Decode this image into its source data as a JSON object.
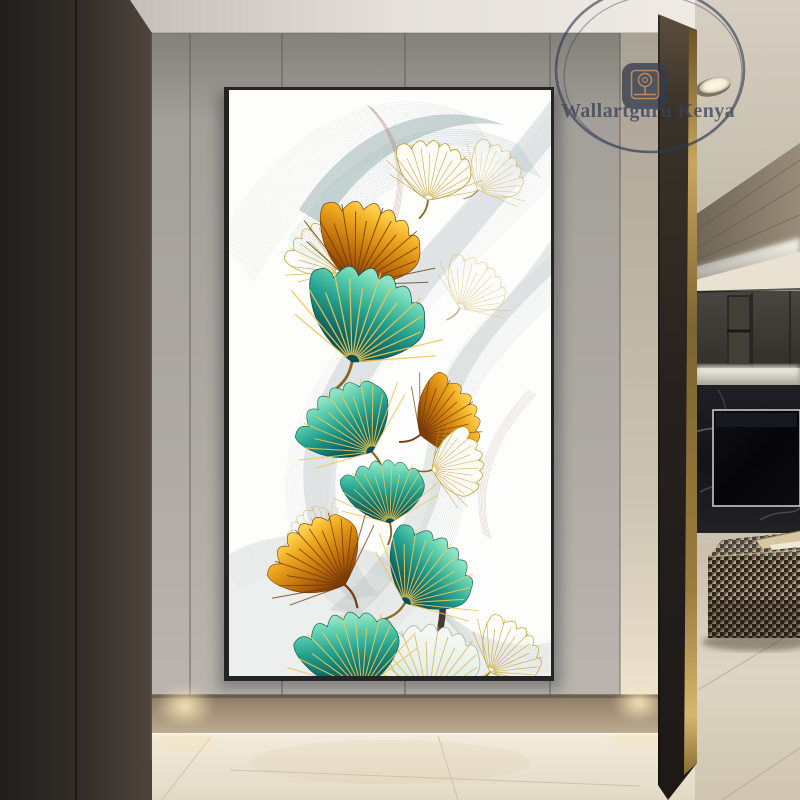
{
  "watermark": {
    "brand": "Wallartguru Kenya",
    "ring_color": "#2c3850",
    "text_color": "#39415a",
    "icon_bg": "#343b4f",
    "icon_stroke": "#c08552"
  },
  "scene": {
    "palette": {
      "left_wall_dark": "#211e1c",
      "left_wall_light": "#4d453d",
      "back_panels_top": "#a09c96",
      "back_panels_bottom": "#b9b4ad",
      "ceiling": "#eeeae4",
      "baseboard_tan": "#a3906f",
      "hall_floor": "#f0e9da",
      "pillar_dark": "#26211d",
      "brass_trim": "#c9a55f",
      "cabinet": "#3e3a36",
      "tv_marble": "#17171a",
      "living_floor": "#d8cfbe",
      "ottoman_dark": "#2b251c",
      "ottoman_light": "#b7a37d",
      "downlight_glow": "#ffe9bd"
    }
  },
  "artwork": {
    "canvas_px": {
      "x": 224,
      "y": 87,
      "w": 330,
      "h": 594
    },
    "face": {
      "x": 229,
      "y": 90,
      "w": 322,
      "h": 586
    },
    "background": "#fdfdfc",
    "palette": {
      "teal_dark": "#063e44",
      "teal_mid": "#23a18e",
      "teal_light": "#8fe3c4",
      "orange_dark": "#5e2a04",
      "orange_mid": "#d2820f",
      "orange_light": "#ffd34f",
      "gold": "#c9a22b",
      "vein_gold": "#f0c75a",
      "vein_dark": "#71380a",
      "pale_leaf": "#e9f1ec",
      "branch": "#342620",
      "ribbon_gray": "#8d9a9b",
      "ribbon_teal": "#2f6d6e",
      "ribbon_red": "#a0543a"
    },
    "bands": [
      {
        "d": "M 322 10 C 240 120 150 190 95 300 C 60 370 70 450 120 510 L 150 505 C 100 448 95 382 125 320 C 175 220 262 130 322 55 Z",
        "fill": "#aab6b8",
        "opacity": 0.3
      },
      {
        "d": "M 70 120 C 120 40 200 5 275 35 C 215 25 140 60 95 135 Z",
        "fill": "#6e8f90",
        "opacity": 0.35
      },
      {
        "d": "M 322 150 C 270 230 210 260 200 340 C 195 410 160 470 100 520 L 130 525 C 185 475 215 420 218 355 C 223 285 275 230 322 185 Z",
        "fill": "#c2cbcb",
        "opacity": 0.42
      },
      {
        "d": "M -10 470 C 60 425 150 445 205 510 C 240 548 280 562 322 552 L 322 586 L -10 586 Z",
        "fill": "#b4bfbf",
        "opacity": 0.22
      }
    ],
    "ribbons": [
      {
        "d": "M -10 150 C 50 40 150 -15 240 25",
        "copies": 22,
        "dx": 1.6,
        "dy": 2.0,
        "color": "#7e9496",
        "opacity": 0.14,
        "width": 0.7
      },
      {
        "d": "M 60 150 C 120 55 205 15 290 55",
        "copies": 18,
        "dx": 1.3,
        "dy": 1.9,
        "color": "#2f6d6e",
        "opacity": 0.16,
        "width": 0.7
      },
      {
        "d": "M 322 25 C 230 140 120 210 70 330 C 45 395 55 465 105 515",
        "copies": 24,
        "dx": 1.8,
        "dy": 0.9,
        "color": "#8d9a9b",
        "opacity": 0.12,
        "width": 0.7
      },
      {
        "d": "M 322 165 C 255 235 195 270 205 360 C 212 430 165 495 110 545",
        "copies": 20,
        "dx": 1.6,
        "dy": 1.0,
        "color": "#6d8283",
        "opacity": 0.14,
        "width": 0.7
      },
      {
        "d": "M -10 470 C 60 425 150 445 205 510 C 235 545 275 560 322 550",
        "copies": 18,
        "dx": 1.2,
        "dy": 1.7,
        "color": "#8fa0a0",
        "opacity": 0.13,
        "width": 0.7
      },
      {
        "d": "M 138 15 C 168 45 178 90 158 140",
        "copies": 5,
        "dx": 1.2,
        "dy": 0.7,
        "color": "#a0543a",
        "opacity": 0.3,
        "width": 0.6
      },
      {
        "d": "M 300 300 C 262 340 238 390 255 445",
        "copies": 6,
        "dx": 1.4,
        "dy": 0.8,
        "color": "#97594a",
        "opacity": 0.22,
        "width": 0.6
      }
    ],
    "leaves": [
      {
        "id": "outline-top-faint",
        "style": "outline",
        "x": 249,
        "y": 100,
        "rot": 45,
        "scale": 0.62,
        "opacity": 0.6
      },
      {
        "id": "outline-top",
        "style": "outline",
        "x": 199,
        "y": 110,
        "rot": 12,
        "scale": 0.75,
        "opacity": 1
      },
      {
        "id": "goldline-left",
        "style": "goldline",
        "x": 111,
        "y": 182,
        "rot": -35,
        "scale": 0.7,
        "opacity": 1
      },
      {
        "id": "goldline-right",
        "style": "goldline",
        "x": 231,
        "y": 218,
        "rot": 35,
        "scale": 0.65,
        "opacity": 0.5
      },
      {
        "id": "orange-top",
        "style": "orange",
        "x": 126,
        "y": 195,
        "rot": 20,
        "scale": 1.05,
        "opacity": 1
      },
      {
        "id": "stem-curl",
        "style": "branch",
        "d": "M 120 205 C 112 230 118 252 132 262",
        "color": "#9c4f22",
        "width": 2.2,
        "opacity": 0.9
      },
      {
        "id": "teal-1",
        "style": "teal",
        "x": 123,
        "y": 272,
        "rot": 18,
        "scale": 1.2,
        "opacity": 1
      },
      {
        "id": "orange-mid",
        "style": "orange",
        "x": 191,
        "y": 345,
        "rot": 58,
        "scale": 0.8,
        "opacity": 1
      },
      {
        "id": "outline-mid",
        "style": "outline",
        "x": 203,
        "y": 380,
        "rot": 78,
        "scale": 0.66,
        "opacity": 1
      },
      {
        "id": "teal-2",
        "style": "teal",
        "x": 143,
        "y": 362,
        "rot": -38,
        "scale": 0.95,
        "opacity": 1
      },
      {
        "id": "teal-3",
        "style": "teal",
        "x": 161,
        "y": 433,
        "rot": -8,
        "scale": 0.8,
        "opacity": 1
      },
      {
        "id": "goldline-small",
        "style": "goldline",
        "x": 101,
        "y": 455,
        "rot": -55,
        "scale": 0.55,
        "opacity": 0.7
      },
      {
        "id": "branch-main",
        "style": "branch",
        "d": "M 175 440 C 210 462 222 505 208 552 C 202 572 188 585 170 592",
        "color": "#342620",
        "width": 6.5,
        "opacity": 0.9
      },
      {
        "id": "teal-4",
        "style": "teal",
        "x": 176,
        "y": 513,
        "rot": 38,
        "scale": 0.95,
        "opacity": 1
      },
      {
        "id": "orange-bottom",
        "style": "orange",
        "x": 116,
        "y": 495,
        "rot": -42,
        "scale": 0.95,
        "opacity": 1
      },
      {
        "id": "goldline-bottom",
        "style": "goldline",
        "x": 261,
        "y": 582,
        "rot": 45,
        "scale": 0.7,
        "opacity": 1
      },
      {
        "id": "pale-bottom",
        "style": "pale",
        "x": 199,
        "y": 610,
        "rot": 8,
        "scale": 0.95,
        "opacity": 1
      },
      {
        "id": "teal-5",
        "style": "teal",
        "x": 133,
        "y": 600,
        "rot": -15,
        "scale": 1.0,
        "opacity": 1
      }
    ]
  }
}
